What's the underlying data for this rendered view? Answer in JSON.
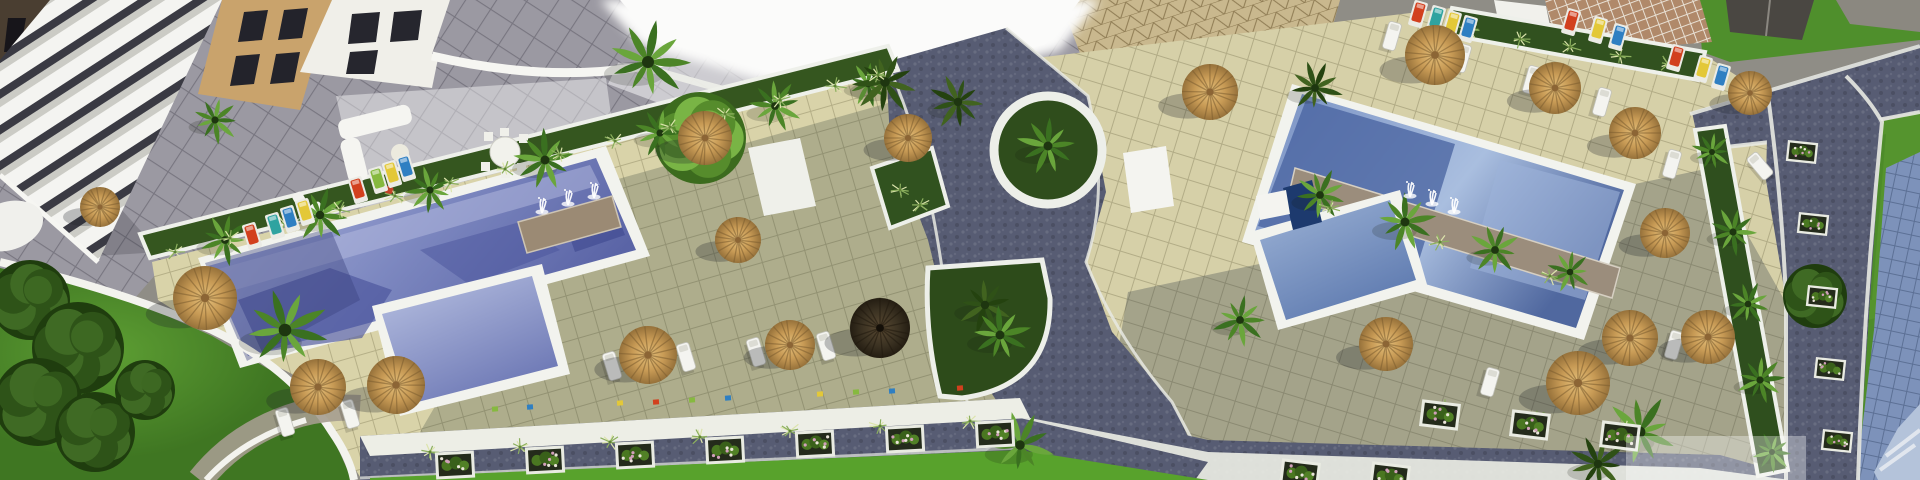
{
  "meta": {
    "kind": "aerial-architectural-render",
    "description": "Top-down 3D rendering of a resort residential complex with two swimming pools, thatch parasols, palm trees, sun loungers, curved white walls, stone pathways and lawns"
  },
  "palette": {
    "ground": "#8f8d86",
    "terrace": "#9b99a2",
    "deck": "#d9d3a9",
    "deck_line": "#a9a37c",
    "path": "#575c73",
    "path_dark": "#4b506а",
    "walkway": "#edeee6",
    "rim_white": "#f2f3ee",
    "pool_light": "#aeb6dd",
    "pool_mid": "#7d88c0",
    "pool_deep": "#5a64a6",
    "lawn_bright": "#58a22c",
    "lawn_right": "#55942e",
    "lawn_dark": "#417a24",
    "foliage_dark": "#2e5318",
    "foliage_light": "#6aa63c",
    "straw": "#c79a55",
    "straw_edge": "#96713a",
    "umbrella_dark": "#3b3222",
    "building_white": "#f4f4f1",
    "building_tan": "#c9a36c",
    "building_side": "#4a3e31",
    "window_dark": "#26262e",
    "pebble": "#9b8a74",
    "rock_band": "#9b8d7c",
    "roof_panels": "#7d92ba",
    "roof_light": "#b4c3da",
    "flower_pink": "#d1a0ba",
    "lounger_colors": {
      "red": "#d2401e",
      "yellow": "#e3c838",
      "blue": "#2f7fc2",
      "green": "#86b93f",
      "teal": "#2fa3a0"
    }
  },
  "scene": {
    "umbrellas": [
      [
        205,
        298,
        32,
        "straw"
      ],
      [
        318,
        387,
        28,
        "straw"
      ],
      [
        396,
        385,
        29,
        "straw"
      ],
      [
        100,
        207,
        20,
        "straw"
      ],
      [
        705,
        138,
        27,
        "straw"
      ],
      [
        738,
        240,
        23,
        "straw"
      ],
      [
        648,
        355,
        29,
        "straw"
      ],
      [
        790,
        345,
        25,
        "straw"
      ],
      [
        908,
        138,
        24,
        "straw"
      ],
      [
        880,
        328,
        30,
        "dark"
      ],
      [
        1210,
        92,
        28,
        "straw"
      ],
      [
        1435,
        55,
        30,
        "straw"
      ],
      [
        1555,
        88,
        26,
        "straw"
      ],
      [
        1635,
        133,
        26,
        "straw"
      ],
      [
        1750,
        93,
        22,
        "straw"
      ],
      [
        1665,
        233,
        25,
        "straw"
      ],
      [
        1630,
        338,
        28,
        "straw"
      ],
      [
        1386,
        344,
        27,
        "straw"
      ],
      [
        1578,
        383,
        32,
        "straw"
      ],
      [
        1708,
        337,
        27,
        "straw"
      ]
    ],
    "palms": [
      [
        225,
        240,
        26,
        "l"
      ],
      [
        320,
        215,
        28,
        "l"
      ],
      [
        430,
        190,
        24,
        "l"
      ],
      [
        545,
        160,
        30,
        "l"
      ],
      [
        660,
        133,
        24,
        "l"
      ],
      [
        775,
        106,
        26,
        "l"
      ],
      [
        868,
        84,
        22,
        "l"
      ],
      [
        648,
        62,
        40,
        "l"
      ],
      [
        885,
        82,
        32,
        "d"
      ],
      [
        958,
        102,
        28,
        "d"
      ],
      [
        285,
        330,
        42,
        "l"
      ],
      [
        215,
        120,
        24,
        "l"
      ],
      [
        985,
        305,
        28,
        "d"
      ],
      [
        1000,
        335,
        30,
        "l"
      ],
      [
        1048,
        146,
        30,
        "l"
      ],
      [
        1320,
        195,
        26,
        "l"
      ],
      [
        1405,
        222,
        30,
        "l"
      ],
      [
        1495,
        250,
        26,
        "l"
      ],
      [
        1570,
        272,
        22,
        "l"
      ],
      [
        1712,
        152,
        20,
        "l"
      ],
      [
        1733,
        232,
        24,
        "l"
      ],
      [
        1748,
        304,
        22,
        "l"
      ],
      [
        1760,
        380,
        24,
        "l"
      ],
      [
        1772,
        452,
        20,
        "l"
      ],
      [
        1640,
        432,
        36,
        "l"
      ],
      [
        1598,
        464,
        28,
        "d"
      ],
      [
        1020,
        445,
        32,
        "l"
      ],
      [
        1240,
        320,
        26,
        "l"
      ],
      [
        1315,
        88,
        26,
        "d"
      ]
    ],
    "trees": [
      [
        700,
        138,
        46,
        "l"
      ],
      [
        30,
        300,
        40,
        "d"
      ],
      [
        78,
        348,
        46,
        "d"
      ],
      [
        38,
        402,
        44,
        "d"
      ],
      [
        95,
        432,
        40,
        "d"
      ],
      [
        145,
        390,
        30,
        "d"
      ],
      [
        1815,
        296,
        32,
        "d"
      ]
    ],
    "loungers_white": [
      [
        612,
        366,
        -17
      ],
      [
        686,
        357,
        -17
      ],
      [
        756,
        352,
        -17
      ],
      [
        826,
        346,
        -17
      ],
      [
        285,
        422,
        -17
      ],
      [
        350,
        414,
        -17
      ],
      [
        1392,
        36,
        16
      ],
      [
        1462,
        58,
        16
      ],
      [
        1532,
        80,
        16
      ],
      [
        1602,
        102,
        16
      ],
      [
        1672,
        164,
        16
      ],
      [
        1760,
        166,
        -40
      ],
      [
        1490,
        382,
        16
      ],
      [
        1674,
        345,
        16
      ]
    ],
    "loungers_colored": [
      [
        252,
        236,
        -17,
        "red"
      ],
      [
        275,
        226,
        -17,
        "teal"
      ],
      [
        290,
        219,
        -17,
        "blue"
      ],
      [
        305,
        212,
        -17,
        "yellow"
      ],
      [
        358,
        190,
        -17,
        "red"
      ],
      [
        378,
        180,
        -17,
        "green"
      ],
      [
        392,
        174,
        -17,
        "yellow"
      ],
      [
        406,
        168,
        -17,
        "blue"
      ],
      [
        1418,
        14,
        16,
        "red"
      ],
      [
        1436,
        19,
        16,
        "teal"
      ],
      [
        1452,
        24,
        16,
        "yellow"
      ],
      [
        1468,
        29,
        16,
        "blue"
      ],
      [
        1571,
        22,
        16,
        "red"
      ],
      [
        1598,
        30,
        16,
        "yellow"
      ],
      [
        1618,
        37,
        16,
        "blue"
      ],
      [
        1676,
        58,
        16,
        "red"
      ],
      [
        1703,
        69,
        16,
        "yellow"
      ],
      [
        1721,
        77,
        16,
        "blue"
      ]
    ],
    "planters": [
      [
        455,
        465,
        -3,
        1
      ],
      [
        545,
        460,
        -3,
        1
      ],
      [
        635,
        455,
        -3,
        1
      ],
      [
        725,
        450,
        -3,
        1
      ],
      [
        815,
        444,
        -3,
        1
      ],
      [
        905,
        439,
        -3,
        1
      ],
      [
        995,
        434,
        -3,
        1
      ],
      [
        1440,
        415,
        7,
        1
      ],
      [
        1530,
        425,
        7,
        1
      ],
      [
        1620,
        436,
        7,
        1
      ],
      [
        1300,
        474,
        7,
        1
      ],
      [
        1390,
        477,
        7,
        1
      ],
      [
        1802,
        152,
        6,
        0.78
      ],
      [
        1813,
        224,
        6,
        0.78
      ],
      [
        1822,
        297,
        6,
        0.78
      ],
      [
        1830,
        369,
        6,
        0.78
      ],
      [
        1837,
        441,
        6,
        0.78
      ]
    ],
    "mini_squares": [
      [
        495,
        409,
        "green"
      ],
      [
        530,
        407,
        "blue"
      ],
      [
        620,
        403,
        "yellow"
      ],
      [
        656,
        402,
        "red"
      ],
      [
        692,
        400,
        "green"
      ],
      [
        728,
        398,
        "blue"
      ],
      [
        820,
        394,
        "yellow"
      ],
      [
        856,
        392,
        "green"
      ],
      [
        892,
        391,
        "blue"
      ],
      [
        960,
        388,
        "red"
      ]
    ],
    "fountains": [
      [
        542,
        212
      ],
      [
        568,
        204
      ],
      [
        594,
        197
      ],
      [
        1410,
        196
      ],
      [
        1432,
        204
      ],
      [
        1454,
        212
      ]
    ],
    "grass": [
      [
        175,
        252
      ],
      [
        230,
        238
      ],
      [
        285,
        224
      ],
      [
        340,
        210
      ],
      [
        395,
        196
      ],
      [
        450,
        183
      ],
      [
        505,
        169
      ],
      [
        560,
        155
      ],
      [
        615,
        141
      ],
      [
        670,
        127
      ],
      [
        725,
        114
      ],
      [
        780,
        100
      ],
      [
        835,
        86
      ],
      [
        878,
        75
      ],
      [
        1470,
        30
      ],
      [
        1520,
        39
      ],
      [
        1570,
        47
      ],
      [
        1620,
        56
      ],
      [
        1668,
        64
      ],
      [
        1330,
        208
      ],
      [
        1440,
        242
      ],
      [
        1550,
        276
      ],
      [
        900,
        190
      ],
      [
        920,
        205
      ],
      [
        430,
        452
      ],
      [
        520,
        447
      ],
      [
        610,
        442
      ],
      [
        700,
        437
      ],
      [
        790,
        431
      ],
      [
        880,
        426
      ],
      [
        970,
        421
      ],
      [
        1445,
        408
      ],
      [
        1535,
        418
      ],
      [
        1625,
        429
      ]
    ]
  }
}
